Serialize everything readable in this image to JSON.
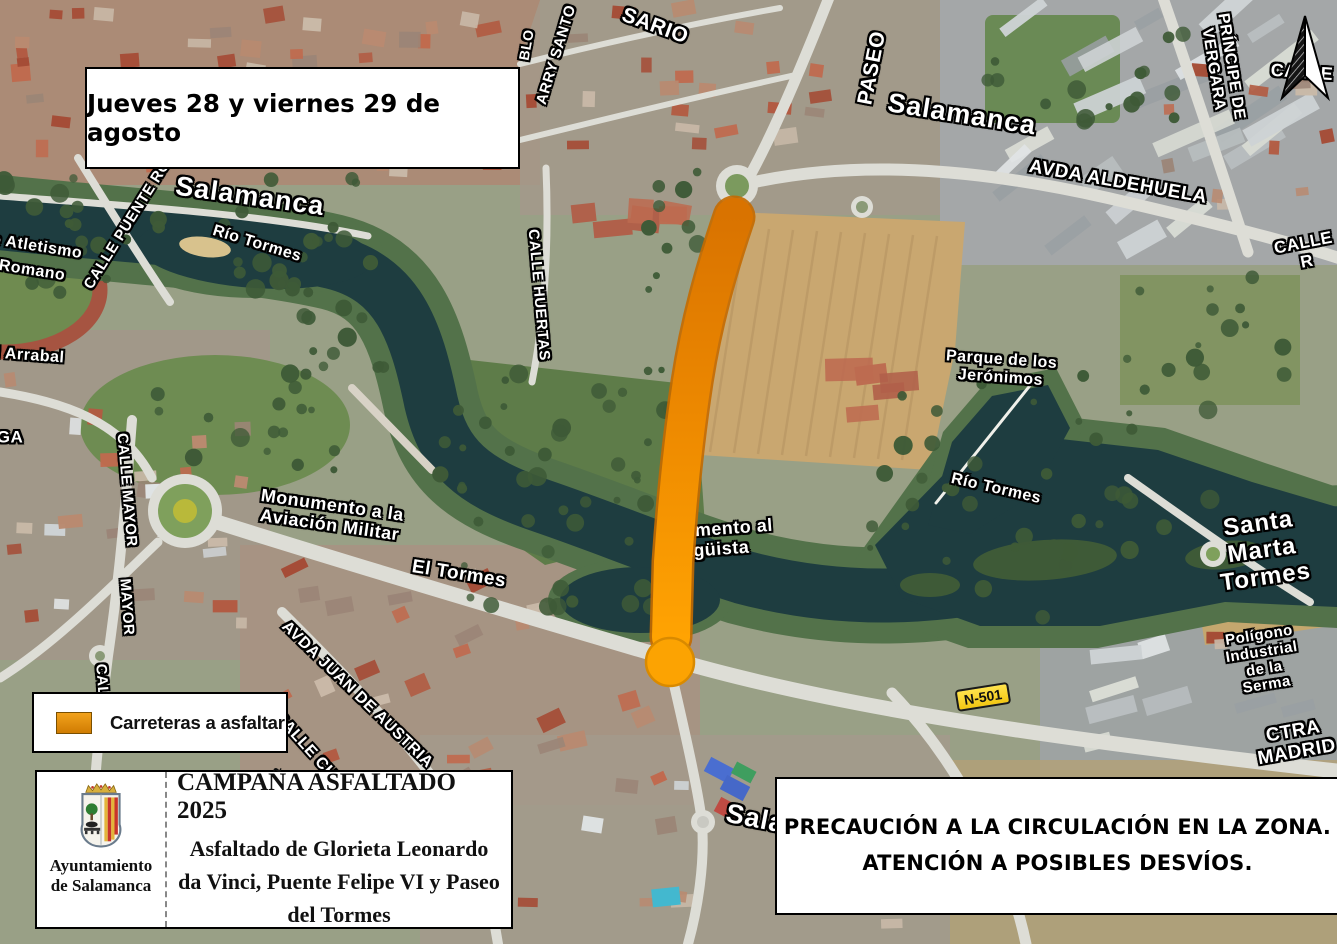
{
  "poster": {
    "date_box": "Jueves 28 y viernes 29 de agosto",
    "legend": {
      "label": "Carreteras a asfaltar",
      "swatch_top": "#F2A21C",
      "swatch_bottom": "#D07C02"
    },
    "campaign": {
      "org": "Ayuntamiento\nde Salamanca",
      "title": "CAMPAÑA ASFALTADO 2025",
      "subtitle": "Asfaltado de Glorieta Leonardo da Vinci, Puente Felipe VI y Paseo del Tormes"
    },
    "warning": "PRECAUCIÓN A LA CIRCULACIÓN EN LA ZONA.\nATENCIÓN A POSIBLES DESVÍOS."
  },
  "route": {
    "meaning": "Carreteras a asfaltar",
    "color_top": "#D97300",
    "color_mid": "#EE8A00",
    "color_bottom": "#FFA302"
  },
  "map": {
    "labels": [
      {
        "name": "label-arry-santo",
        "text": "ARRY SANTO",
        "x": 557,
        "y": 55,
        "rot": -73,
        "size": 15
      },
      {
        "name": "label-sario",
        "text": "SARIO",
        "x": 655,
        "y": 26,
        "rot": 20,
        "size": 21
      },
      {
        "name": "label-paseo",
        "text": "PASEO",
        "x": 872,
        "y": 68,
        "rot": -79,
        "size": 21
      },
      {
        "name": "label-blo",
        "text": "BLO",
        "x": 527,
        "y": 45,
        "rot": -80,
        "size": 14
      },
      {
        "name": "label-salamanca-north",
        "text": "Salamanca",
        "x": 962,
        "y": 114,
        "rot": 9,
        "size": 27,
        "cls": "city"
      },
      {
        "name": "label-avda-aldehuela",
        "text": "AVDA ALDEHUELA",
        "x": 1118,
        "y": 182,
        "rot": 10,
        "size": 19
      },
      {
        "name": "label-calle-principe-vergara",
        "text": "PRÍNCIPE DE VERGARA",
        "x": 1222,
        "y": 68,
        "rot": 81,
        "size": 16
      },
      {
        "name": "label-calle-top-right",
        "text": "CALLE",
        "x": 1302,
        "y": 72,
        "rot": 4,
        "size": 18
      },
      {
        "name": "label-calle-r",
        "text": "CALLE R",
        "x": 1305,
        "y": 252,
        "rot": -11,
        "size": 17
      },
      {
        "name": "label-salamanca-west",
        "text": "Salamanca",
        "x": 250,
        "y": 196,
        "rot": 8,
        "size": 27,
        "cls": "city"
      },
      {
        "name": "label-rio-tormes-west",
        "text": "Río Tormes",
        "x": 257,
        "y": 244,
        "rot": 17,
        "size": 16
      },
      {
        "name": "label-calle-puente-romano",
        "text": "CALLE PUENTE RO",
        "x": 128,
        "y": 225,
        "rot": -58,
        "size": 15
      },
      {
        "name": "label-atletismo-line1",
        "text": "e Atletismo",
        "x": 37,
        "y": 247,
        "rot": 9,
        "size": 16
      },
      {
        "name": "label-atletismo-line2",
        "text": "Romano",
        "x": 32,
        "y": 271,
        "rot": 9,
        "size": 16
      },
      {
        "name": "label-arrabal",
        "text": "l Arrabal",
        "x": 30,
        "y": 356,
        "rot": 4,
        "size": 16
      },
      {
        "name": "label-ga",
        "text": "GA",
        "x": 10,
        "y": 437,
        "rot": 0,
        "size": 17
      },
      {
        "name": "label-calle-huertas",
        "text": "CALLE HUERTAS",
        "x": 538,
        "y": 295,
        "rot": 85,
        "size": 15
      },
      {
        "name": "label-calle-mayor",
        "text": "CALLE MAYOR",
        "x": 126,
        "y": 490,
        "rot": 85,
        "size": 15
      },
      {
        "name": "label-mayor",
        "text": "MAYOR",
        "x": 126,
        "y": 607,
        "rot": 86,
        "size": 15
      },
      {
        "name": "label-cal",
        "text": "CAL",
        "x": 101,
        "y": 680,
        "rot": 86,
        "size": 15
      },
      {
        "name": "label-monumento-aviacion",
        "text": "Monumento a la\nAviación Militar",
        "x": 331,
        "y": 515,
        "rot": 8,
        "size": 18
      },
      {
        "name": "label-el-tormes",
        "text": "El Tormes",
        "x": 459,
        "y": 574,
        "rot": 9,
        "size": 19
      },
      {
        "name": "label-monumento-frag1",
        "text": "umento al",
        "x": 728,
        "y": 528,
        "rot": -4,
        "size": 18
      },
      {
        "name": "label-monumento-frag2",
        "text": "agüista",
        "x": 716,
        "y": 549,
        "rot": -4,
        "size": 18
      },
      {
        "name": "label-rio-tormes-east",
        "text": "Río Tormes",
        "x": 996,
        "y": 489,
        "rot": 13,
        "size": 16
      },
      {
        "name": "label-parque-jeronimos",
        "text": "Parque de los\nJerónimos",
        "x": 1001,
        "y": 369,
        "rot": 4,
        "size": 16
      },
      {
        "name": "label-santa-marta-tormes",
        "text": "Santa Marta\nTormes",
        "x": 1262,
        "y": 551,
        "rot": -8,
        "size": 24,
        "cls": "city"
      },
      {
        "name": "label-poligono-serma",
        "text": "Polígono Industrial\nde la Serma",
        "x": 1263,
        "y": 661,
        "rot": -9,
        "size": 15
      },
      {
        "name": "road-shield-n501",
        "text": "N-501",
        "x": 983,
        "y": 697,
        "rot": -9,
        "size": 14,
        "cls": "shield"
      },
      {
        "name": "label-ctra-madrid",
        "text": "CTRA MADRID",
        "x": 1295,
        "y": 742,
        "rot": -10,
        "size": 19
      },
      {
        "name": "label-avda-juan-de-austria",
        "text": "AVDA JUAN DE AUSTRIA",
        "x": 357,
        "y": 695,
        "rot": 44,
        "size": 16
      },
      {
        "name": "label-calle-ch",
        "text": "CALLE CH",
        "x": 305,
        "y": 746,
        "rot": 48,
        "size": 16
      },
      {
        "name": "label-salamanca-south",
        "text": "Salamanca",
        "x": 800,
        "y": 827,
        "rot": 11,
        "size": 27,
        "cls": "city"
      }
    ]
  }
}
